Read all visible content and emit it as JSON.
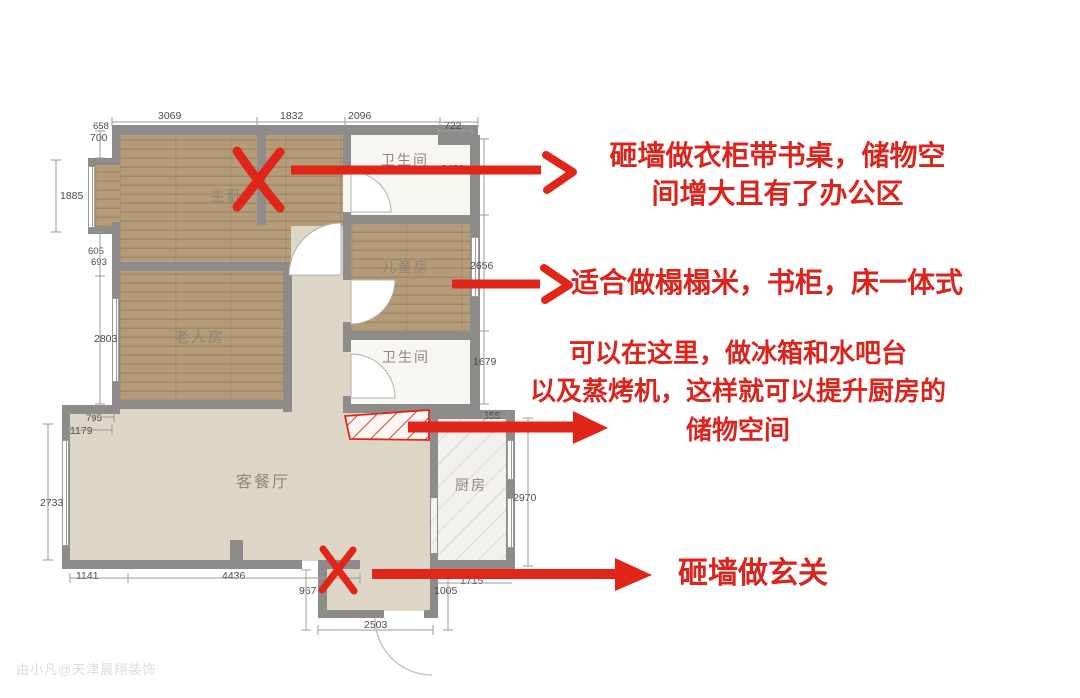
{
  "rooms": {
    "master": "主卧",
    "bath_top": "卫生间",
    "kids": "儿童房",
    "elder": "老人房",
    "bath_mid": "卫生间",
    "living": "客餐厅",
    "kitchen": "厨房"
  },
  "dims": {
    "top": [
      "3069",
      "1832",
      "2096",
      "722"
    ],
    "left": [
      "658",
      "700",
      "1885",
      "605",
      "693",
      "2803",
      "795",
      "1179",
      "2733"
    ],
    "right": [
      "2420",
      "2656",
      "1679",
      "555",
      "2970"
    ],
    "bottom": [
      "1141",
      "4436",
      "967",
      "2503",
      "1005",
      "1715"
    ]
  },
  "annotations": {
    "wardrobe": {
      "line1": "砸墙做衣柜带书桌，储物空",
      "line2": "间增大且有了办公区"
    },
    "tatami": "适合做榻榻米，书柜，床一体式",
    "kitchenbar": {
      "line1": "可以在这里，做冰箱和水吧台",
      "line2": "以及蒸烤机，这样就可以提升厨房的",
      "line3": "储物空间"
    },
    "entry": "砸墙做玄关"
  },
  "watermark": "由小凡@天津晨翔装饰",
  "colors": {
    "annotation_red": "#d9251d",
    "mark_red": "#e02519",
    "wall_gray": "#8d8c8a",
    "wood_floor": "#b49b79",
    "living_beige": "#ddd6c6",
    "bath_white": "#f7f6f3"
  }
}
